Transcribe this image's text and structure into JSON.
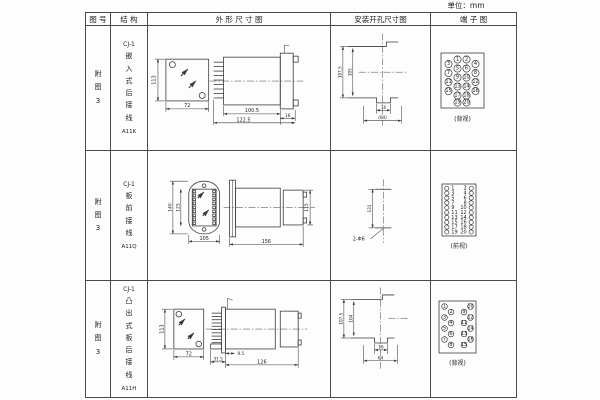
{
  "page": {
    "unit_label": "单位：mm"
  },
  "header": {
    "fig_no": "图 号",
    "structure": "结 构",
    "outline": "外 形 尺 寸 图",
    "mounting": "安装开孔尺寸图",
    "terminal": "端 子 图"
  },
  "rows": [
    {
      "fig": "附图3",
      "model": "CJ-1",
      "structure": "嵌入式后接线",
      "code": "A11K",
      "outline_dims": {
        "height": "113",
        "width": "72",
        "body": "100.5",
        "total": "122.5",
        "flange": "16"
      },
      "mounting_dims": {
        "outer": "107.5",
        "inner": "105",
        "small": "16",
        "bottom": "(64)"
      },
      "terminal": {
        "label": "(背视)",
        "numbers": [
          1,
          2,
          3,
          4,
          5,
          6,
          7,
          8,
          9,
          10,
          11,
          12,
          13,
          14,
          15,
          16,
          17,
          18,
          19,
          20
        ]
      }
    },
    {
      "fig": "附图3",
      "model": "CJ-1",
      "structure": "板前接线",
      "code": "A11Q",
      "outline_dims": {
        "outer_h": "140",
        "inner_h": "125",
        "width": "105",
        "length": "156",
        "side_h": "115"
      },
      "mounting_dims": {
        "spacing": "131",
        "holes": "2-Φ6"
      },
      "terminal": {
        "label": "(前视)",
        "left_numbers": [
          1,
          3,
          5,
          7,
          9,
          11,
          13,
          15,
          17,
          19
        ],
        "right_numbers": [
          2,
          4,
          6,
          8,
          10,
          12,
          14,
          16,
          18,
          20
        ]
      }
    },
    {
      "fig": "附图3",
      "model": "CJ-1",
      "structure": "凸出式板后接线",
      "code": "A11H",
      "outline_dims": {
        "height": "113",
        "width": "72",
        "base": "31.5",
        "pins": "9.5",
        "length": "126"
      },
      "mounting_dims": {
        "outer": "107.5",
        "inner": "104",
        "small": "16",
        "bottom": "64"
      },
      "terminal": {
        "label": "(背视)",
        "numbers": [
          1,
          2,
          3,
          4,
          5,
          6,
          7,
          8,
          9,
          10,
          11,
          12,
          13,
          14,
          15,
          16
        ]
      }
    }
  ]
}
